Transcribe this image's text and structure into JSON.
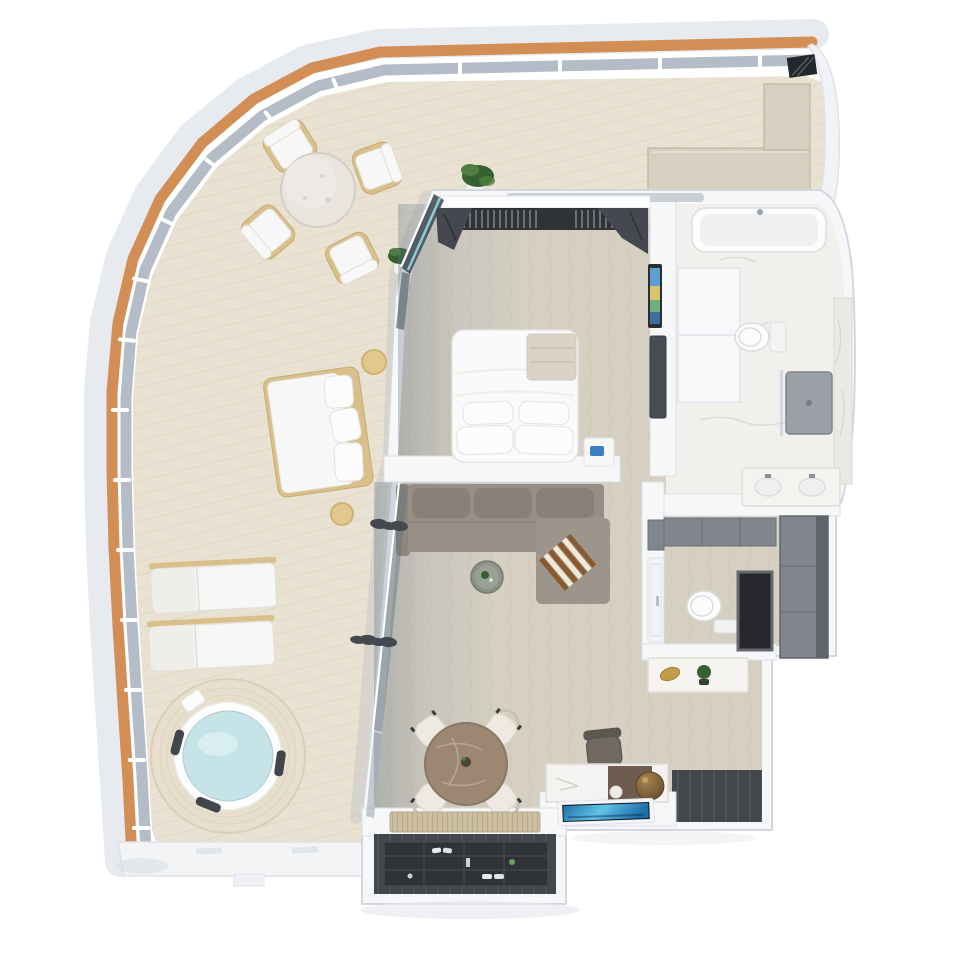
{
  "meta": {
    "title": "3D top-down rendering of a ship suite floor plan with wrap-around private balcony",
    "render_style": "photoreal isometric top view",
    "canvas": {
      "width": 960,
      "height": 960
    },
    "visible_text": []
  },
  "colors": {
    "canvas": "#ffffff",
    "hull": "#e7eaee",
    "wood-trim": "#d28e55",
    "railing": "#b3bcc7",
    "deck": "#e9e2d2",
    "deck-line": "#d8cfbc",
    "deck-edge": "#f3f4f6",
    "bench-tan": "#d7d0c0",
    "wall": "#f6f7f9",
    "wall-edge": "#d5d9df",
    "carpet": "#d6d0c3",
    "carpet-line": "#b9b2a2",
    "marble": "#f1f0ed",
    "marble-vein": "#dcdbd6",
    "wood-light": "#cdbfa2",
    "floor-dark": "#43464b",
    "floor-dark-line": "#5f646c",
    "shelf-dark": "#2f3236",
    "cabinet": "#81868e",
    "cabinet-dark": "#5f646b",
    "niche": "#26282c",
    "niche-frame": "#66696e",
    "fixture": "#fcfcfd",
    "fixture-line": "#d9dce0",
    "shower": "#9aa0a6",
    "glass-teal": "#8fd2e2",
    "glass-dark": "#3c4650",
    "curtain": "#45494f",
    "sofa": "#978e85",
    "sofa-dark": "#898077",
    "chaise": "#9d948b",
    "throw-a": "#8a5a2e",
    "throw-b": "#f2ead9",
    "stone-table": "#9c8772",
    "stone-vein": "#bfae9a",
    "chair-cream": "#efeae1",
    "chair-edge": "#d8d2c6",
    "chair-leg": "#3a3b3e",
    "wood-frame": "#d9c08b",
    "cushion": "#f7f7f7",
    "cushion-edge": "#e6e3db",
    "water": "#c5e3e6",
    "water-hi": "#dcf0f1",
    "tub-deck": "#e7dfcb",
    "headrest": "#41464c",
    "plant": "#356032",
    "plant-light": "#4d8040",
    "pot": "#f2f2f2",
    "bed": "#fafafa",
    "bed-edge": "#e5e4e1",
    "bed-throw": "#d9d3c7",
    "pillow": "#fcfcfc",
    "vent": "#c7cbd1",
    "tv-b1": "#1d6fa8",
    "tv-b2": "#62c3e8",
    "bronze-hi": "#a8854f",
    "bronze-lo": "#5e452a",
    "leather": "#6e5c50",
    "desk-marble": "#f4f3f1",
    "gold": "#c39b4a",
    "art-blue": "#5d9fd0",
    "art-yellow": "#d9c469",
    "art-green": "#6fae7d"
  },
  "rooms": {
    "balcony": {
      "label": "Wrap-around balcony with teak rail",
      "furniture": [
        "outdoor-dining-table",
        "outdoor-chair x4",
        "potted-plant x2",
        "outdoor-daybed",
        "round-side-table x2",
        "sun-lounger x2",
        "whirlpool-hot-tub",
        "built-in-bench"
      ]
    },
    "bedroom": {
      "label": "Bedroom",
      "furniture": [
        "wardrobe-with-hangers",
        "curtains",
        "double-bed",
        "pillows",
        "nightstand",
        "wall-art",
        "tv-panel"
      ]
    },
    "bathroom": {
      "label": "Master bathroom",
      "furniture": [
        "bathtub",
        "linen-cabinet",
        "toilet",
        "shower",
        "vanity-with-two-sinks",
        "marble-wall"
      ]
    },
    "dressing": {
      "label": "Dressing corridor",
      "furniture": [
        "low-cabinets",
        "tall-wardrobe",
        "console-with-decor"
      ]
    },
    "wc": {
      "label": "Guest toilet room",
      "furniture": [
        "door",
        "toilet",
        "dark-storage-niche"
      ]
    },
    "living": {
      "label": "Living room",
      "furniture": [
        "sectional-sofa-with-chaise",
        "striped-throw",
        "round-side-table-with-plant",
        "curtains"
      ]
    },
    "dining": {
      "label": "Dining area",
      "furniture": [
        "round-stone-dining-table",
        "dining-chair x4",
        "table-centerpiece"
      ]
    },
    "desk": {
      "label": "Desk nook",
      "furniture": [
        "writing-desk",
        "desk-chair",
        "bronze-sphere-decor",
        "wall-mounted-tv"
      ]
    },
    "entry": {
      "label": "Entry hall",
      "furniture": [
        "sliding-wood-door",
        "shoe-shelf-with-items",
        "dark-plank-floor"
      ]
    }
  }
}
